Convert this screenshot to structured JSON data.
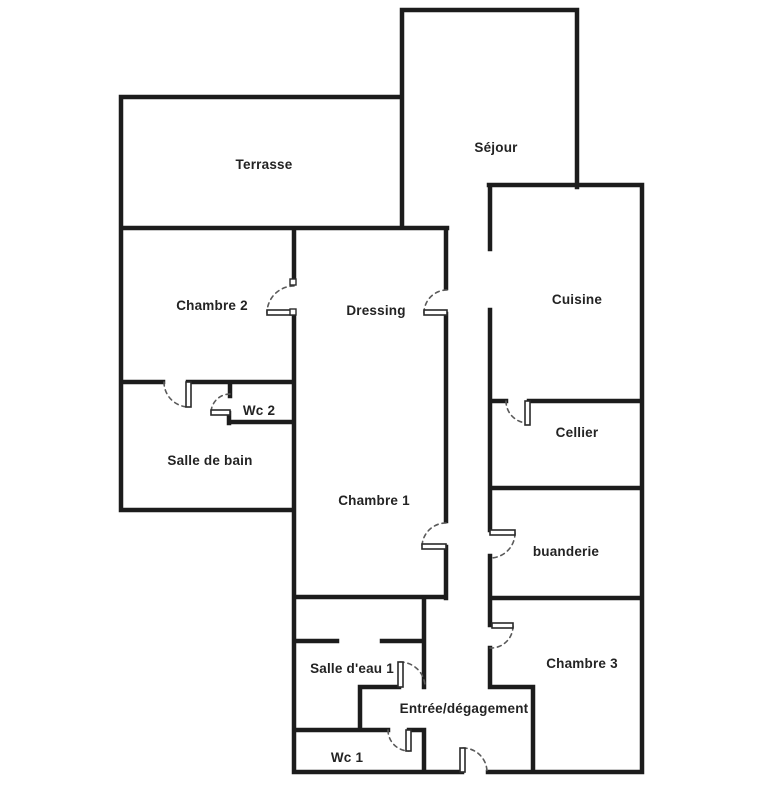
{
  "page": {
    "background_color": "#ffffff"
  },
  "floorplan": {
    "type": "floor-plan",
    "wall_color": "#1c1c1c",
    "label_color": "#232323",
    "door_arc_color": "#5a5a5a",
    "rooms": {
      "terrasse": "Terrasse",
      "sejour": "Séjour",
      "chambre2": "Chambre 2",
      "dressing": "Dressing",
      "cuisine": "Cuisine",
      "wc2": "Wc 2",
      "salle_de_bain": "Salle de bain",
      "cellier": "Cellier",
      "chambre1": "Chambre 1",
      "buanderie": "buanderie",
      "salle_deau1": "Salle d'eau 1",
      "chambre3": "Chambre 3",
      "entree": "Entrée/dégagement",
      "wc1": "Wc 1"
    }
  }
}
